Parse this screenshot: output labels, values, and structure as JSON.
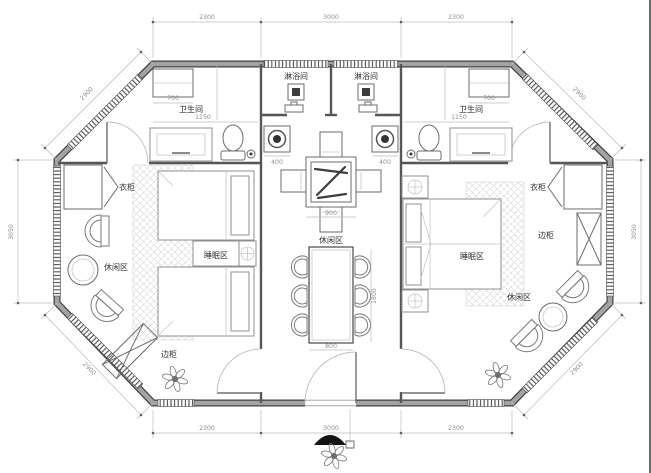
{
  "rooms": {
    "shower_left": "淋浴间",
    "shower_right": "淋浴间",
    "bath_left": "卫生间",
    "bath_right": "卫生间",
    "wardrobe_left": "衣柜",
    "wardrobe_right": "衣柜",
    "leisure_left": "休闲区",
    "leisure_center": "休闲区",
    "leisure_right": "休闲区",
    "sleep_left": "睡眠区",
    "sleep_right": "睡眠区",
    "cabinet_left": "边柜",
    "cabinet_right": "边柜"
  },
  "dims": {
    "top_left": "2300",
    "top_mid": "3000",
    "top_right": "2300",
    "bottom_left": "2300",
    "bottom_mid": "3000",
    "bottom_right": "2300",
    "side_left": "3050",
    "side_right": "3050",
    "diag_tl": "2900",
    "diag_tr": "2900",
    "diag_bl": "2900",
    "diag_br": "2900",
    "bath_left_width": "1150",
    "bath_right_width": "1150",
    "window_left": "700",
    "window_right": "700",
    "basin_left": "400",
    "basin_right": "400",
    "table_center": "900",
    "dining_width": "800",
    "dining_length": "1800"
  },
  "colors": {
    "background": "#ffffff",
    "wall_edge": "#3f3f3f",
    "wall_fill": "#a3a3a3",
    "partition": "#565656",
    "dim_line": "#bcbcbc",
    "dim_text": "#8f8f8f",
    "label_text": "#303030",
    "carpet_hatch": "#d6d6d6"
  }
}
